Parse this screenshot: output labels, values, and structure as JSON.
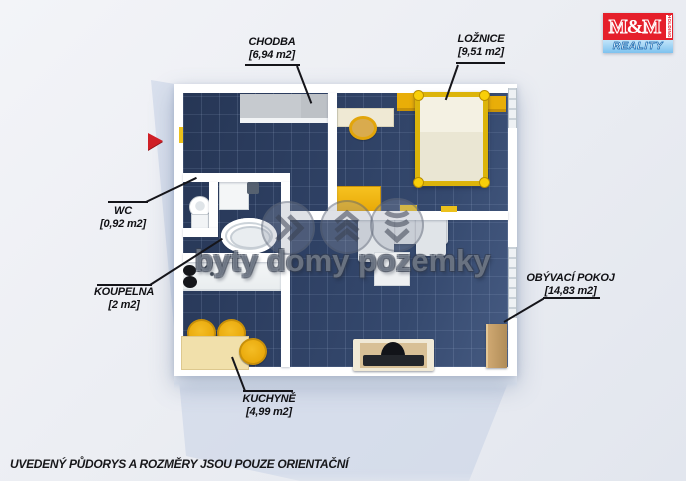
{
  "logo": {
    "m1": "M",
    "amp": "&",
    "m2": "M",
    "holding": "HOLDING",
    "reality": "REALITY"
  },
  "rooms": [
    {
      "key": "chodba",
      "name": "CHODBA",
      "area": "[6,94 m2]"
    },
    {
      "key": "loznice",
      "name": "LOŽNICE",
      "area": "[9,51 m2]"
    },
    {
      "key": "wc",
      "name": "WC",
      "area": "[0,92 m2]"
    },
    {
      "key": "koupelna",
      "name": "KOUPELNA",
      "area": "[2 m2]"
    },
    {
      "key": "kuchyne",
      "name": "KUCHYNĚ",
      "area": "[4,99 m2]"
    },
    {
      "key": "obyvaci",
      "name": "OBÝVACÍ POKOJ",
      "area": "[14,83 m2]"
    }
  ],
  "watermark": {
    "text": "byty domy pozemky",
    "icons": [
      "chevrons-right-icon",
      "chevrons-up-icon",
      "chevrons-down-icon"
    ]
  },
  "disclaimer": "UVEDENÝ PŮDORYS A ROZMĚRY JSOU POUZE ORIENTAČNÍ",
  "colors": {
    "floor_navy": "#2e4063",
    "wall_white": "#ffffff",
    "accent_yellow": "#eeb008",
    "logo_red": "#e51f2b",
    "logo_blue": "#7ec2ef",
    "arrow_red": "#cf1f26",
    "label_text": "#101014"
  }
}
